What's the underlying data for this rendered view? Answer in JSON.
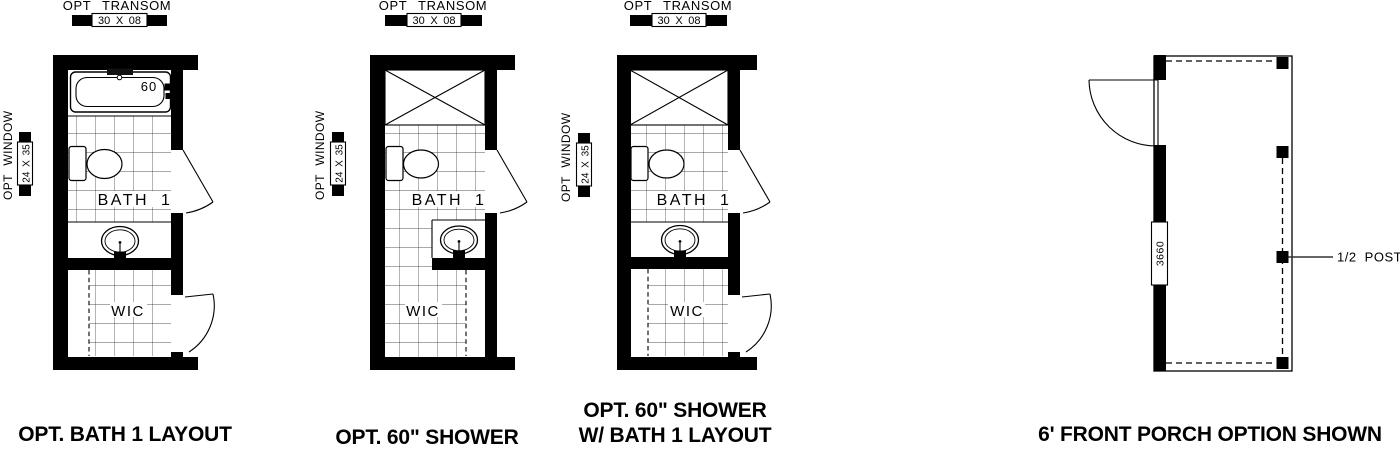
{
  "plans": [
    {
      "caption": "OPT. BATH 1 LAYOUT",
      "transom_label": "OPT TRANSOM",
      "transom_size": "30 X 08",
      "window_label": "OPT WINDOW",
      "window_size": "24 X 35",
      "room_label": "BATH 1",
      "closet_label": "WIC",
      "tub_label": "60"
    },
    {
      "caption": "OPT. 60\" SHOWER",
      "transom_label": "OPT TRANSOM",
      "transom_size": "30 X 08",
      "window_label": "OPT WINDOW",
      "window_size": "24 X 35",
      "room_label": "BATH 1",
      "closet_label": "WIC"
    },
    {
      "caption_line1": "OPT. 60\" SHOWER",
      "caption_line2": "W/ BATH 1 LAYOUT",
      "transom_label": "OPT TRANSOM",
      "transom_size": "30 X 08",
      "window_label": "OPT WINDOW",
      "window_size": "24 X 35",
      "room_label": "BATH 1",
      "closet_label": "WIC"
    }
  ],
  "porch": {
    "caption": "6' FRONT PORCH OPTION SHOWN",
    "window_size_label": "3660",
    "post_label": "1/2 POST"
  },
  "colors": {
    "ink": "#000000",
    "paper": "#ffffff"
  }
}
